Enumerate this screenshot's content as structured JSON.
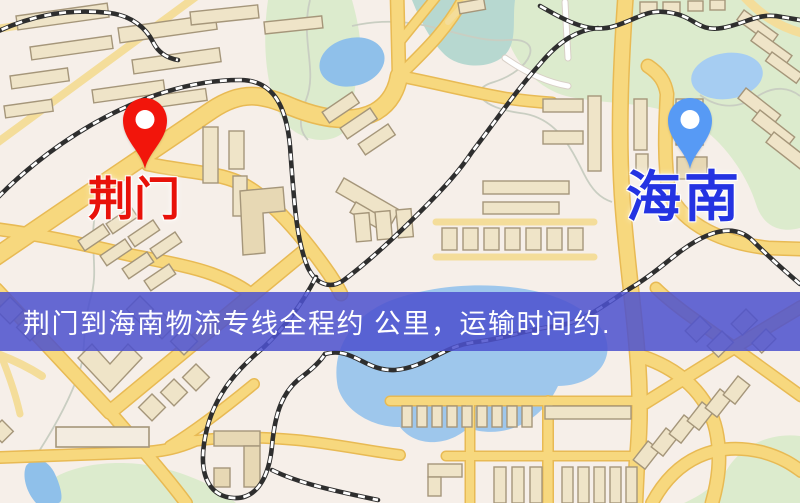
{
  "map_overlay": {
    "banner": {
      "text": "荆门到海南物流专线全程约 公里，运输时间约.",
      "background_color": "rgba(77, 81, 206, 0.86)",
      "text_color": "#ffffff"
    },
    "origin": {
      "label": "荆门",
      "label_color": "#e8120a",
      "pin_color": "#f2150b",
      "pin_icon": "red-location-pin-icon"
    },
    "destination": {
      "label": "海南",
      "label_color": "#2433e2",
      "pin_color": "#579af5",
      "pin_icon": "blue-location-pin-icon"
    }
  },
  "palette": {
    "map_background": "#f6efe9",
    "road_fill": "#f7d87e",
    "road_casing": "#e8ba54",
    "park_green": "#dcebcd",
    "water_blue": "#9ec7ec",
    "building_fill": "#efe4c8",
    "railway_dark": "#2e2e2e"
  }
}
